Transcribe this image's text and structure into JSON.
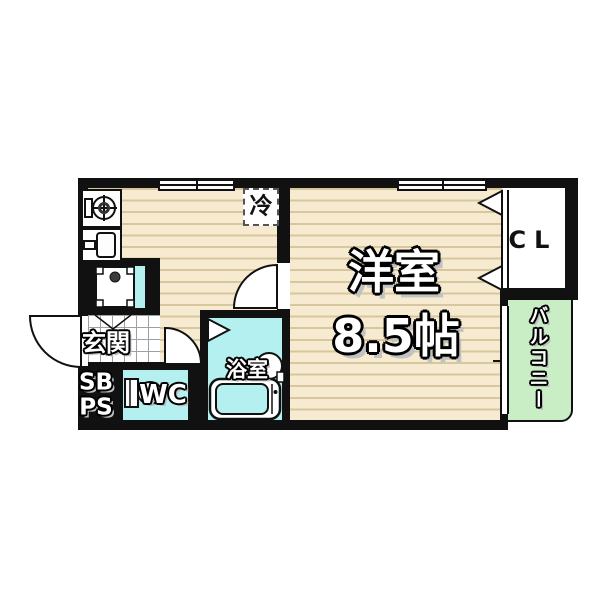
{
  "floor_plan": {
    "rooms": {
      "western_room": {
        "name": "洋室",
        "size": "8.5帖"
      },
      "closet": {
        "label": "CL"
      },
      "balcony": {
        "label": "バルコニー"
      },
      "entrance": {
        "label": "玄関"
      },
      "bathroom": {
        "label": "浴室"
      },
      "toilet": {
        "label": "WC"
      },
      "shaft": {
        "line1": "SB",
        "line2": "PS"
      },
      "refrigerator_space": {
        "label": "冷"
      }
    },
    "colors": {
      "wall": "#111111",
      "floor": "#f6ebd0",
      "floor_stripe": "#d8c69f",
      "wet_area": "#b4f0f0",
      "balcony": "#c9eec6",
      "label_fill": "#ffffff",
      "label_outline": "#000000"
    }
  }
}
